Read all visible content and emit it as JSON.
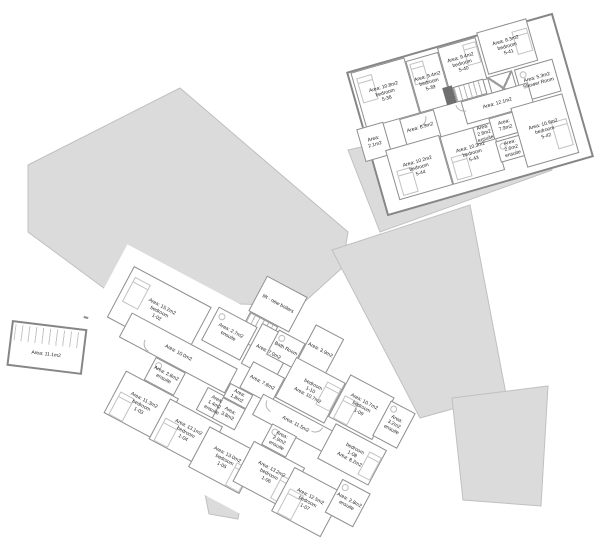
{
  "document": {
    "type": "architectural floor plan",
    "background": "#ffffff"
  },
  "colors": {
    "wall": "#8d8d8d",
    "silhouette_fill": "#dbdbdb",
    "silhouette_stroke": "#c0c0c0",
    "furniture": "#c2c2c2",
    "label_text": "#222222"
  },
  "upper_floor": {
    "rooms": [
      {
        "name": "bedroom",
        "number": "5-38",
        "area": "Area: 10.8m2"
      },
      {
        "name": "bedroom",
        "number": "5-39",
        "area": "Area: 9.4m2"
      },
      {
        "name": "bedroom",
        "number": "5-40",
        "area": "Area: 9.4m2"
      },
      {
        "name": "bedroom",
        "number": "5-41",
        "area": "Area: 8.3m2"
      },
      {
        "name": "Shower Room",
        "area": "Area: 5.3m2"
      },
      {
        "name": "bedroom",
        "number": "5-42",
        "area": "Area: 10.9m2"
      },
      {
        "name": "ensuite",
        "area": "Area: 2.6m2"
      },
      {
        "area": "Area: 7.9m2"
      },
      {
        "area": "Area: 12.1m2"
      },
      {
        "area": "Area: 6.9m2"
      },
      {
        "area": "Area: 2.1m2"
      },
      {
        "name": "bedroom",
        "number": "5-44",
        "area": "Area: 10.2m2"
      },
      {
        "name": "bedroom",
        "number": "5-43",
        "area": "Area: 10.3m2"
      },
      {
        "name": "ensuite",
        "area": "Area: 2.8m2"
      }
    ]
  },
  "lower_floor": {
    "rooms": [
      {
        "name": "bedroom",
        "number": "1-02",
        "area": "Area: 15.2m2"
      },
      {
        "name": "ensuite",
        "area": "Area: 2.7m2"
      },
      {
        "area": "Area: 7.0m2"
      },
      {
        "name": "lift - new boilers"
      },
      {
        "area": "Area: 3.9m2"
      },
      {
        "name": "Bath Room"
      },
      {
        "area": "Area: 7.8m2"
      },
      {
        "area": "Area: 10.0m2"
      },
      {
        "name": "ensuite",
        "area": "Area: 2.8m2"
      },
      {
        "name": "bedroom",
        "number": "1-03",
        "area": "Area: 11.3m2"
      },
      {
        "name": "bedroom",
        "number": "1-04",
        "area": "Area: 13.1m2"
      },
      {
        "name": "ensuite",
        "area": "Area: 1.4m2"
      },
      {
        "area": "Area: 1.8m2"
      },
      {
        "area": "Area: 3.8m2"
      },
      {
        "name": "bedroom",
        "number": "1-05",
        "area": "Area: 13.0m2"
      },
      {
        "name": "ensuite",
        "area": "Area: 2.9m2"
      },
      {
        "name": "bedroom",
        "number": "1-06",
        "area": "Area: 13.2m2"
      },
      {
        "name": "bedroom",
        "number": "1-07",
        "area": "Area: 12.5m2"
      },
      {
        "name": "ensuite",
        "area": "Area: 2.8m2"
      },
      {
        "name": "bedroom",
        "number": "1-08",
        "area": "Area: 8.2m2"
      },
      {
        "name": "bedroom",
        "number": "1-09",
        "area": "Area: 10.7m2"
      },
      {
        "name": "ensuite",
        "area": "Area: 3.2m2"
      },
      {
        "name": "bedroom",
        "number": "1-10",
        "area": "Area: 10.7m2"
      },
      {
        "area": "Area: 11.5m2"
      }
    ]
  },
  "outbuilding": {
    "area": "Area: 11.1m2"
  },
  "link_corridor": {
    "area": "Area: 6.0m2"
  }
}
